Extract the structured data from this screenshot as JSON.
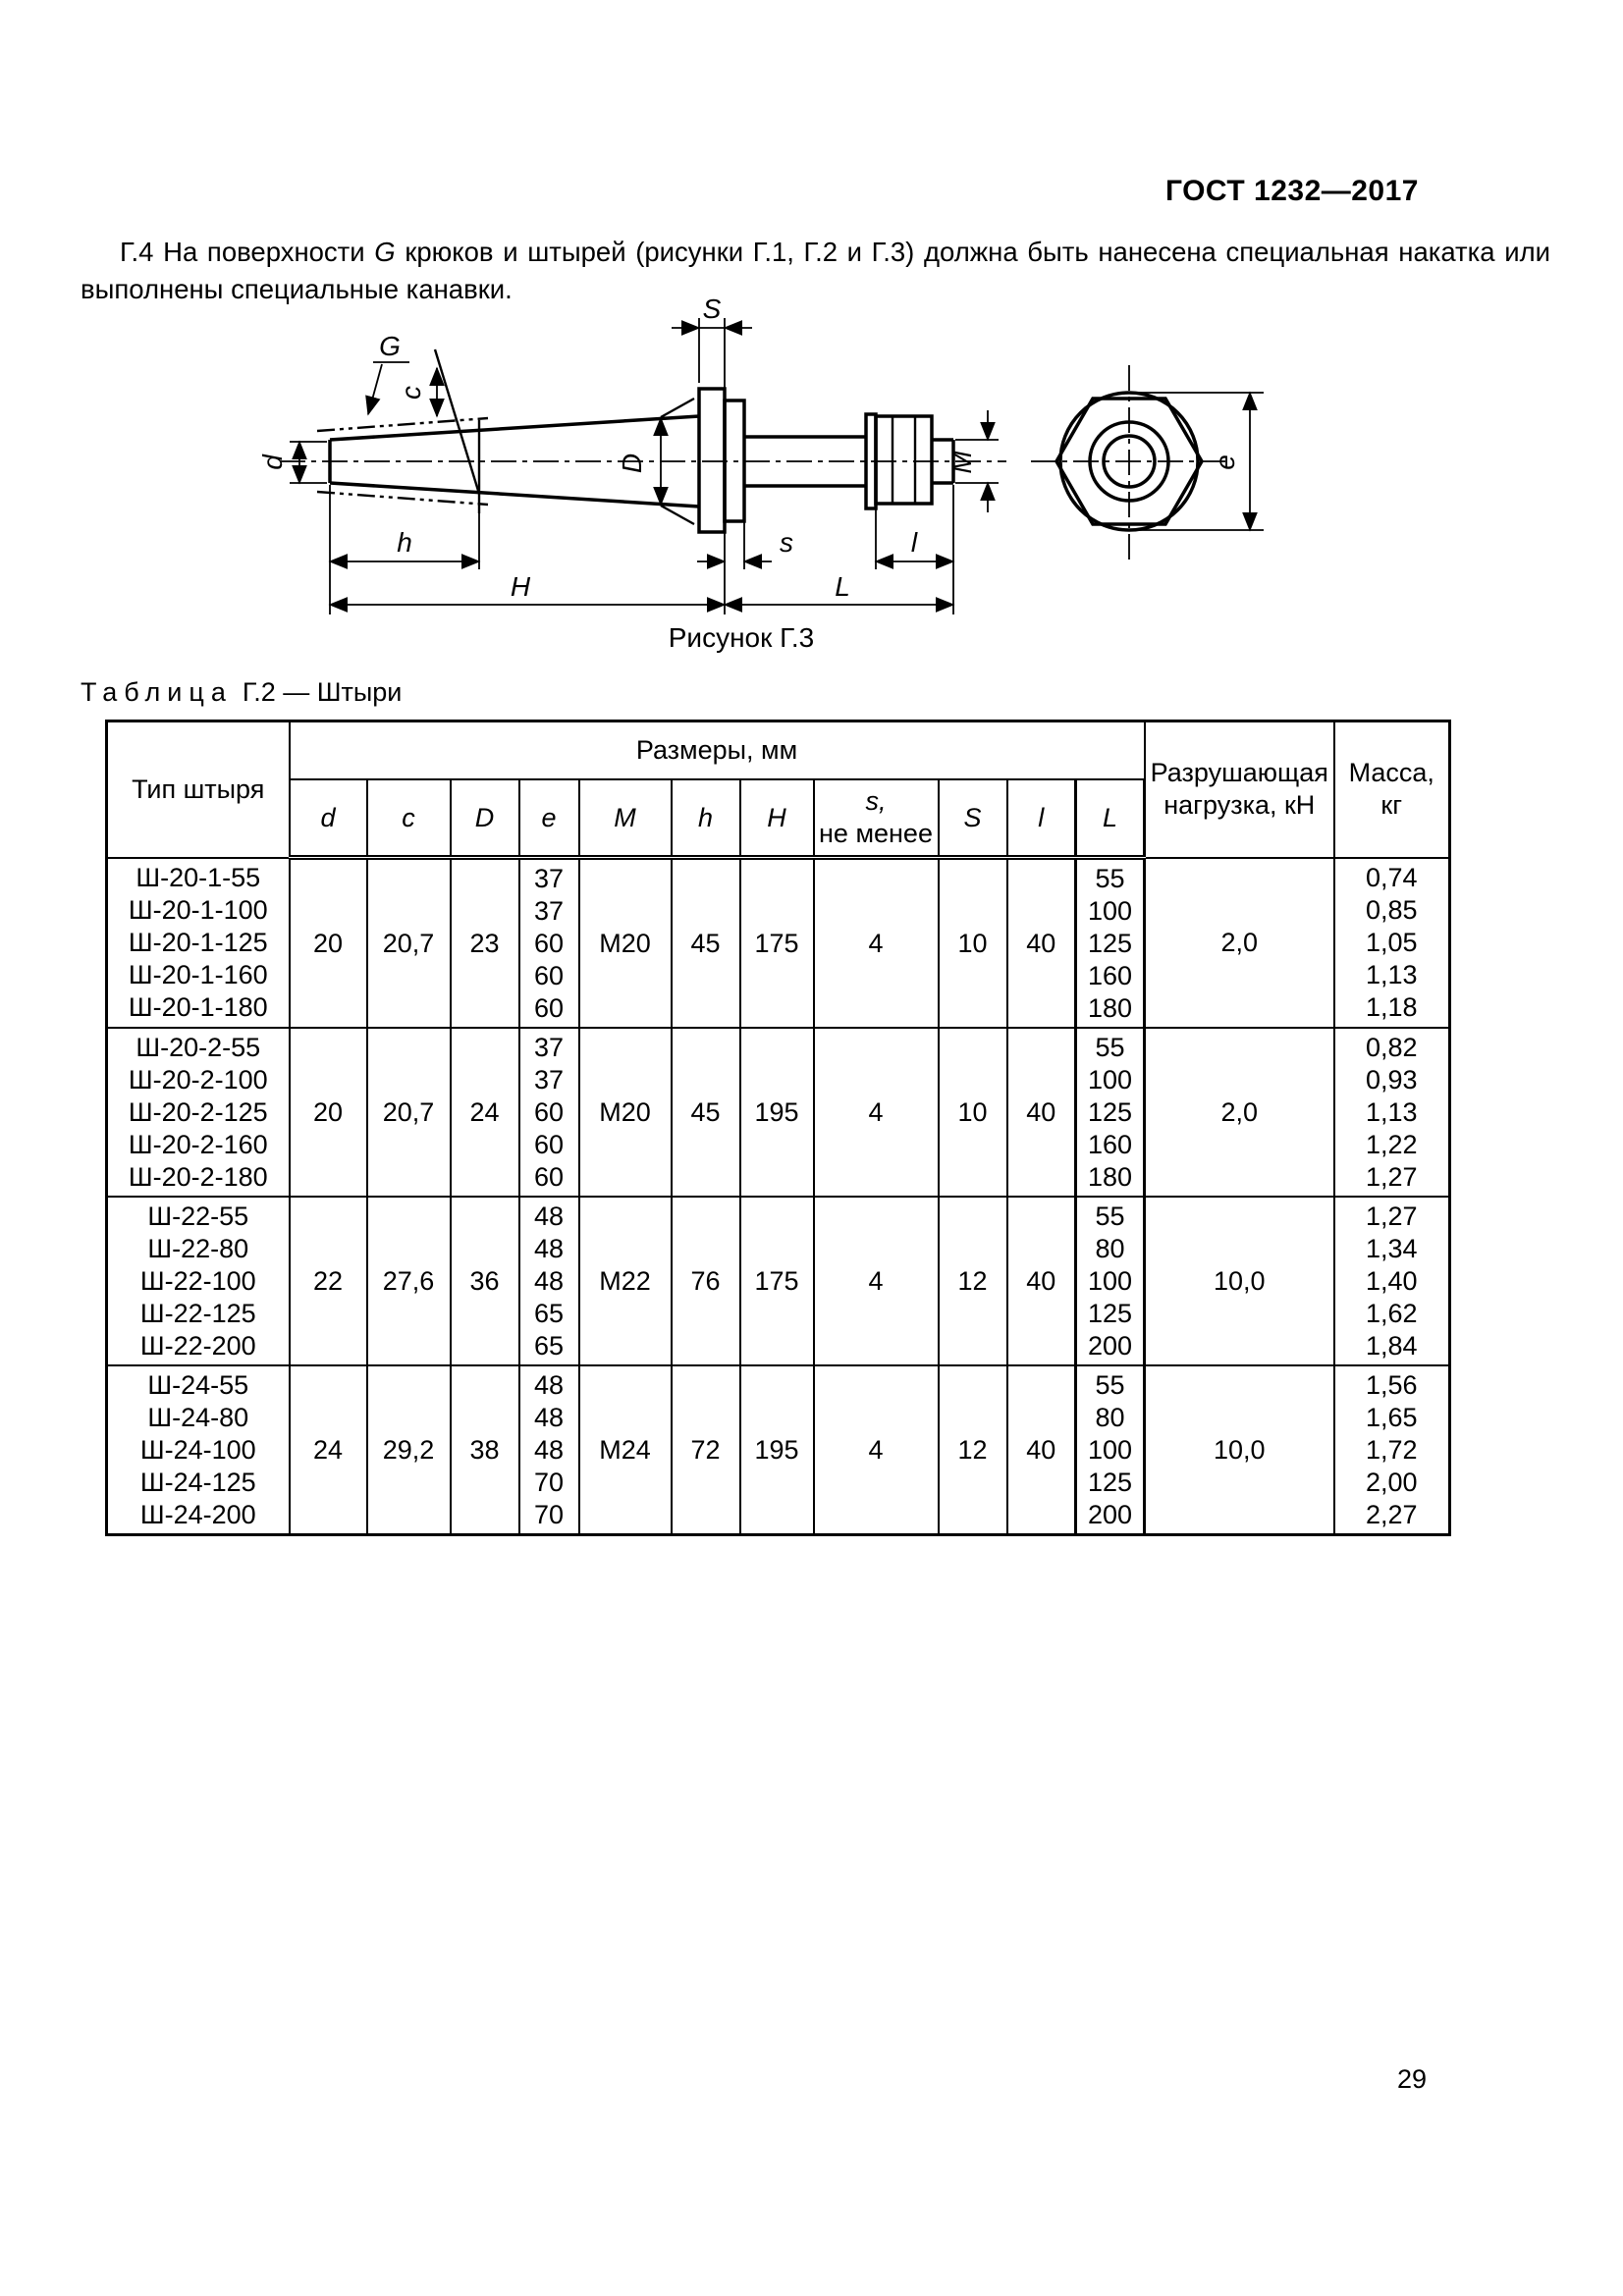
{
  "page": {
    "standard_ref": "ГОСТ 1232—2017",
    "number": "29"
  },
  "paragraph": {
    "before_g": "Г.4  На поверхности ",
    "g": "G",
    "after_g": " крюков и штырей (рисунки Г.1, Г.2 и Г.3) должна быть нанесена специальная накатка или выполнены специальные канавки."
  },
  "figure": {
    "caption": "Рисунок Г.3",
    "labels": {
      "G": "G",
      "c": "c",
      "d": "d",
      "D": "D",
      "S": "S",
      "M": "M",
      "e": "e",
      "h": "h",
      "H": "H",
      "s": "s",
      "l": "l",
      "L": "L"
    }
  },
  "table": {
    "title_word": "Таблица",
    "title_rest": "Г.2 — Штыри",
    "header": {
      "type": "Тип штыря",
      "sizes_group": "Размеры, мм",
      "dims": [
        "d",
        "c",
        "D",
        "e",
        "M",
        "h",
        "H",
        "S",
        "l",
        "L"
      ],
      "s_head_top": "s,",
      "s_head_bottom": "не менее",
      "load": "Разрушающая нагрузка, кН",
      "mass": "Масса,\nкг"
    },
    "blocks": [
      {
        "types": [
          "Ш-20-1-55",
          "Ш-20-1-100",
          "Ш-20-1-125",
          "Ш-20-1-160",
          "Ш-20-1-180"
        ],
        "d": "20",
        "c": "20,7",
        "D": "23",
        "e": [
          "37",
          "37",
          "60",
          "60",
          "60"
        ],
        "M": "М20",
        "h": "45",
        "H": "175",
        "s": "4",
        "S": "10",
        "l": "40",
        "L": [
          "55",
          "100",
          "125",
          "160",
          "180"
        ],
        "load": "2,0",
        "mass": [
          "0,74",
          "0,85",
          "1,05",
          "1,13",
          "1,18"
        ]
      },
      {
        "types": [
          "Ш-20-2-55",
          "Ш-20-2-100",
          "Ш-20-2-125",
          "Ш-20-2-160",
          "Ш-20-2-180"
        ],
        "d": "20",
        "c": "20,7",
        "D": "24",
        "e": [
          "37",
          "37",
          "60",
          "60",
          "60"
        ],
        "M": "М20",
        "h": "45",
        "H": "195",
        "s": "4",
        "S": "10",
        "l": "40",
        "L": [
          "55",
          "100",
          "125",
          "160",
          "180"
        ],
        "load": "2,0",
        "mass": [
          "0,82",
          "0,93",
          "1,13",
          "1,22",
          "1,27"
        ]
      },
      {
        "types": [
          "Ш-22-55",
          "Ш-22-80",
          "Ш-22-100",
          "Ш-22-125",
          "Ш-22-200"
        ],
        "d": "22",
        "c": "27,6",
        "D": "36",
        "e": [
          "48",
          "48",
          "48",
          "65",
          "65"
        ],
        "M": "М22",
        "h": "76",
        "H": "175",
        "s": "4",
        "S": "12",
        "l": "40",
        "L": [
          "55",
          "80",
          "100",
          "125",
          "200"
        ],
        "load": "10,0",
        "mass": [
          "1,27",
          "1,34",
          "1,40",
          "1,62",
          "1,84"
        ]
      },
      {
        "types": [
          "Ш-24-55",
          "Ш-24-80",
          "Ш-24-100",
          "Ш-24-125",
          "Ш-24-200"
        ],
        "d": "24",
        "c": "29,2",
        "D": "38",
        "e": [
          "48",
          "48",
          "48",
          "70",
          "70"
        ],
        "M": "М24",
        "h": "72",
        "H": "195",
        "s": "4",
        "S": "12",
        "l": "40",
        "L": [
          "55",
          "80",
          "100",
          "125",
          "200"
        ],
        "load": "10,0",
        "mass": [
          "1,56",
          "1,65",
          "1,72",
          "2,00",
          "2,27"
        ]
      }
    ]
  }
}
